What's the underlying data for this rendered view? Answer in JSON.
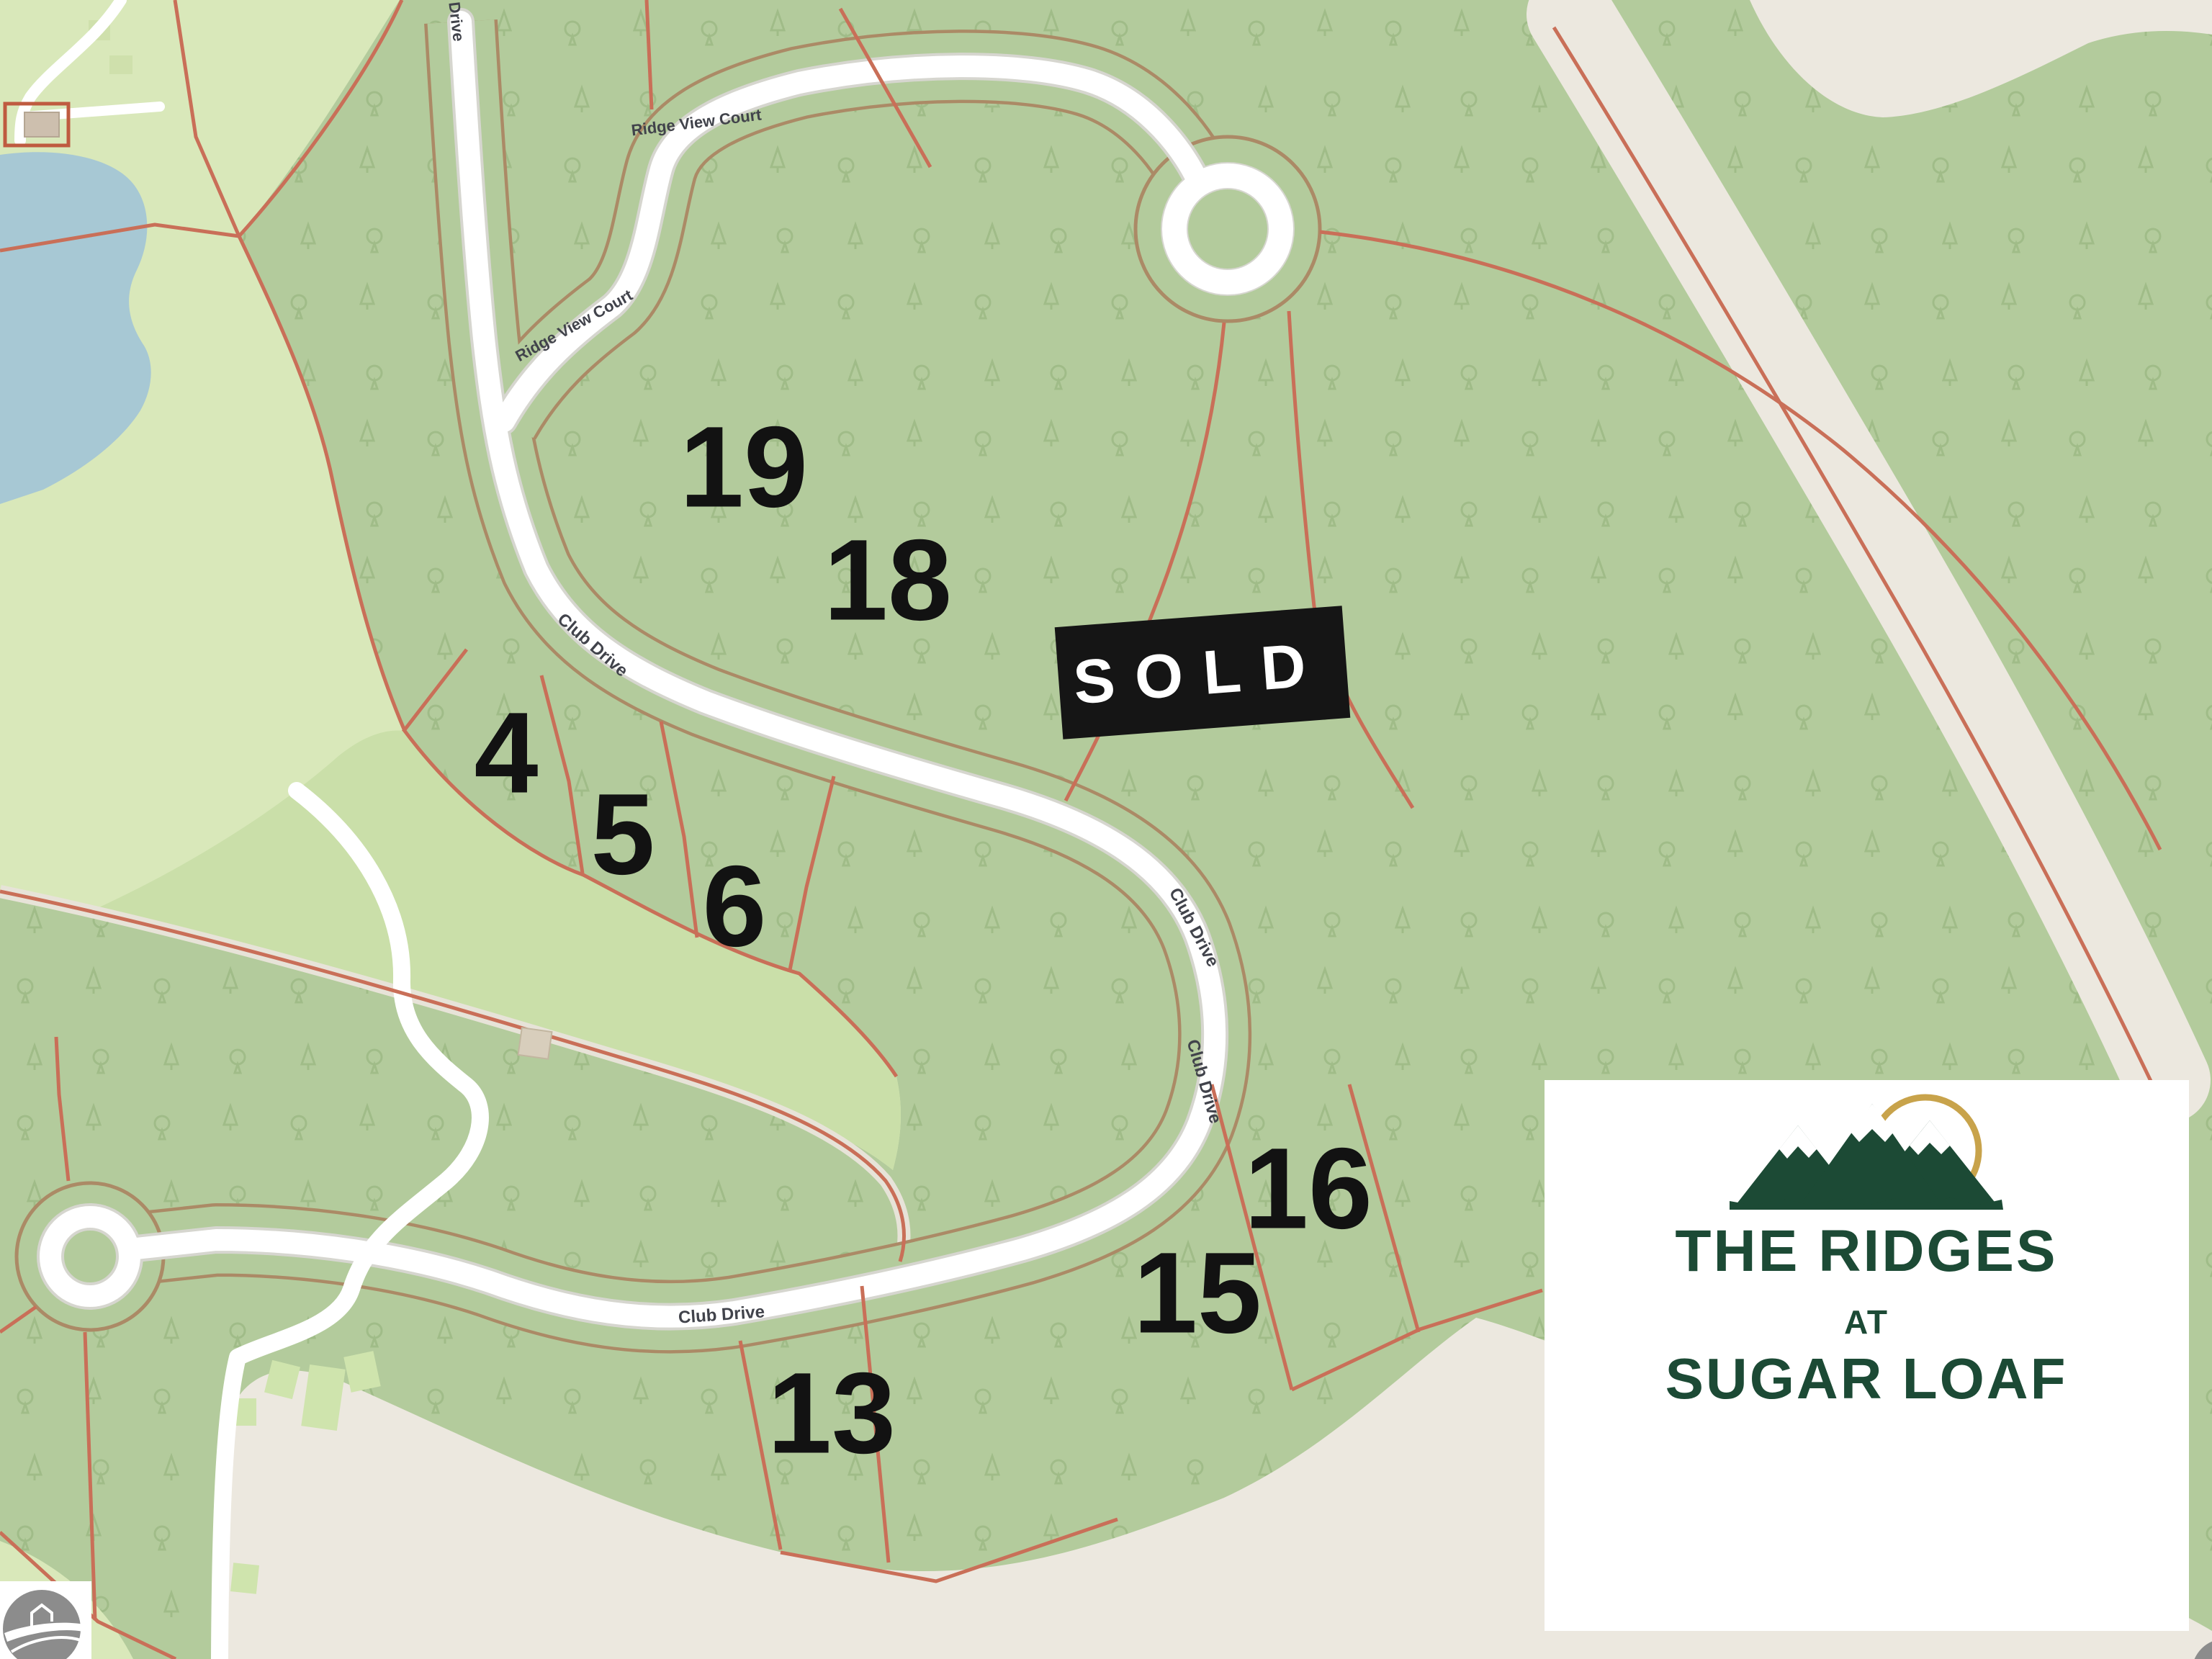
{
  "map": {
    "lots": [
      {
        "id": "lot-19",
        "label": "19"
      },
      {
        "id": "lot-18",
        "label": "18"
      },
      {
        "id": "lot-4",
        "label": "4"
      },
      {
        "id": "lot-5",
        "label": "5"
      },
      {
        "id": "lot-6",
        "label": "6"
      },
      {
        "id": "lot-13",
        "label": "13"
      },
      {
        "id": "lot-15",
        "label": "15"
      },
      {
        "id": "lot-16",
        "label": "16"
      }
    ],
    "road_labels": [
      {
        "id": "ridge-view-court-upper",
        "text": "Ridge View Court"
      },
      {
        "id": "ridge-view-court-lower",
        "text": "Ridge View Court"
      },
      {
        "id": "club-drive-upper",
        "text": "Club Drive"
      },
      {
        "id": "club-drive-mid-1",
        "text": "Club Drive"
      },
      {
        "id": "club-drive-mid-2",
        "text": "Club Drive"
      },
      {
        "id": "club-drive-lower",
        "text": "Club Drive"
      },
      {
        "id": "drive-top-partial",
        "text": "Drive"
      }
    ],
    "sold_badge": {
      "label": "SOLD"
    },
    "logo_card": {
      "line1": "THE RIDGES",
      "line2": "AT",
      "line3": "SUGAR LOAF"
    },
    "colors": {
      "forest_green": "#b3cb9c",
      "tree_glyph_green": "#8fae78",
      "open_green": "#d9e8ba",
      "fairway_green": "#cadfa9",
      "cleared_beige": "#ece8df",
      "water_blue": "#a7c8d4",
      "road_white": "#ffffff",
      "road_casing_brown": "#ab8a66",
      "parcel_line_red": "#c96f58",
      "sold_black": "#151515",
      "logo_green": "#1c4a35",
      "sun_gold": "#c8a34b",
      "watermark_gray": "#8c8c8c"
    }
  }
}
